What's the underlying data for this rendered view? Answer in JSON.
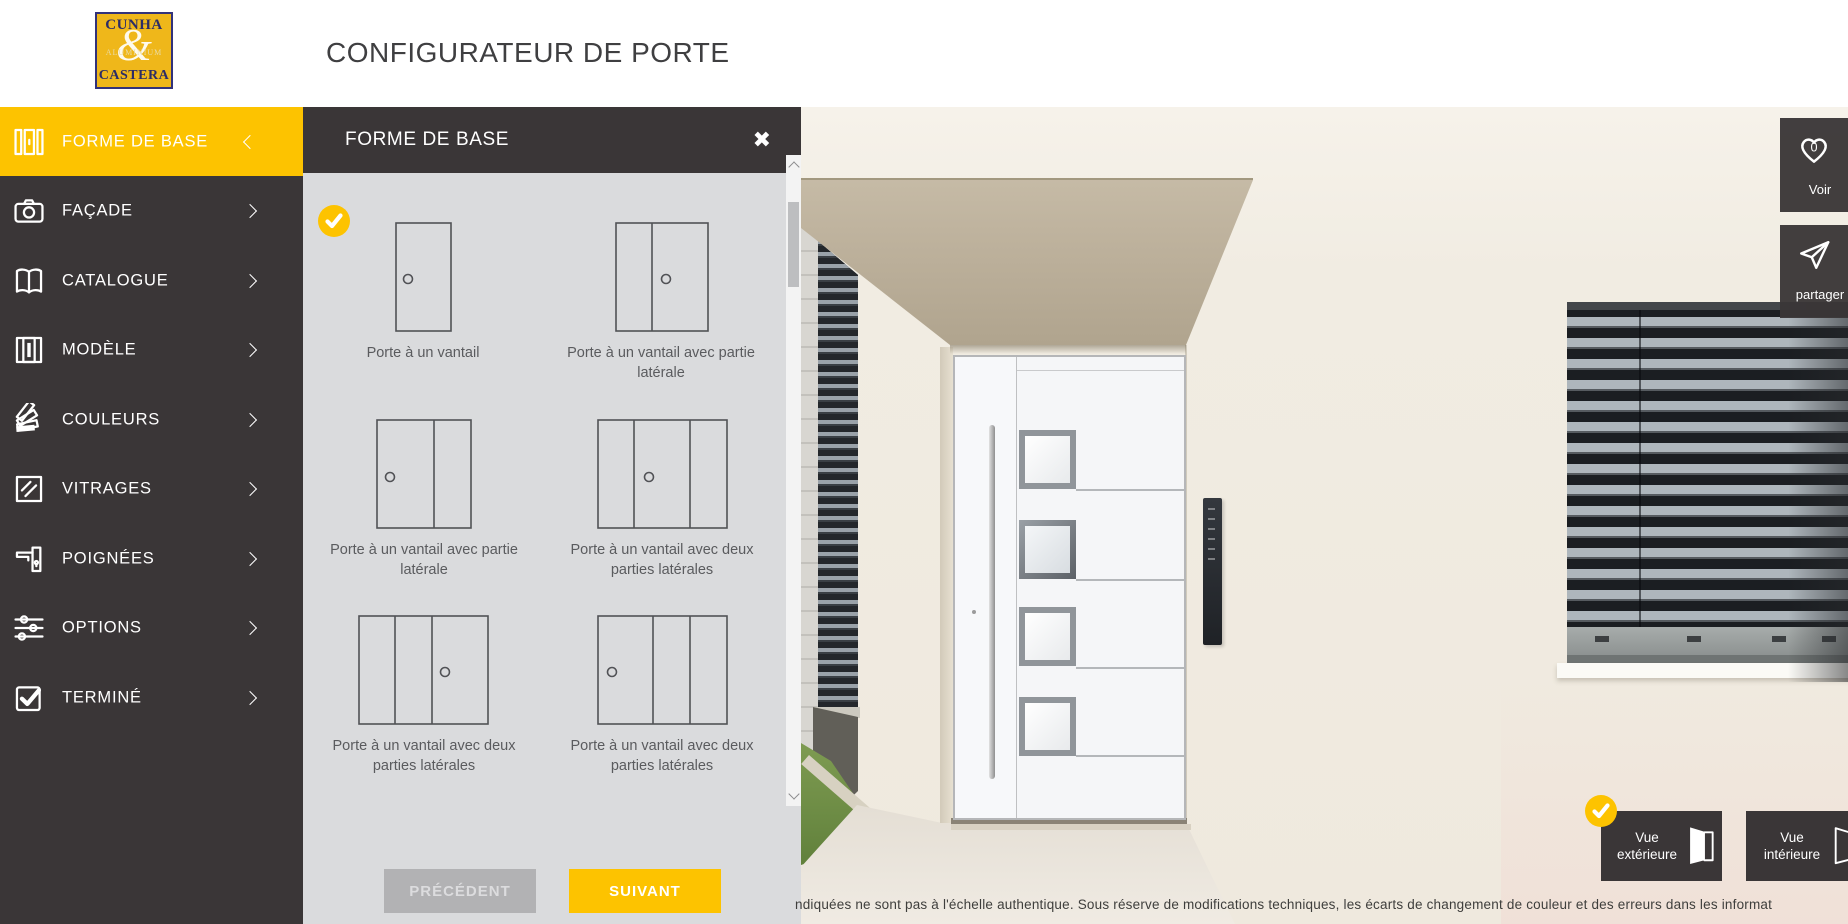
{
  "colors": {
    "accent": "#fdc300",
    "sidebar": "#3a3637",
    "panel_bg": "#dadbdd",
    "logo_bg": "#efb71a"
  },
  "header": {
    "title": "CONFIGURATEUR DE PORTE",
    "logo": {
      "line1": "CUNHA",
      "amp": "&",
      "line2": "ALUMINIUM",
      "line3": "CASTERA"
    }
  },
  "sidebar": {
    "items": [
      {
        "label": "FORME DE BASE",
        "icon": "door-shape-icon",
        "active": true,
        "chevron": "left"
      },
      {
        "label": "FAÇADE",
        "icon": "camera-icon",
        "active": false,
        "chevron": "right"
      },
      {
        "label": "CATALOGUE",
        "icon": "open-book-icon",
        "active": false,
        "chevron": "right"
      },
      {
        "label": "MODÈLE",
        "icon": "door-panel-icon",
        "active": false,
        "chevron": "right"
      },
      {
        "label": "COULEURS",
        "icon": "color-fan-icon",
        "active": false,
        "chevron": "right"
      },
      {
        "label": "VITRAGES",
        "icon": "glass-pane-icon",
        "active": false,
        "chevron": "right"
      },
      {
        "label": "POIGNÉES",
        "icon": "door-handle-icon",
        "active": false,
        "chevron": "right"
      },
      {
        "label": "OPTIONS",
        "icon": "sliders-icon",
        "active": false,
        "chevron": "right"
      },
      {
        "label": "TERMINÉ",
        "icon": "checkbox-icon",
        "active": false,
        "chevron": "right"
      }
    ]
  },
  "panel": {
    "title": "FORME DE BASE",
    "close_icon": "✖",
    "selected_option": 0,
    "options": [
      {
        "label": "Porte à un vantail",
        "selected": true
      },
      {
        "label": "Porte à un vantail avec partie latérale",
        "selected": false
      },
      {
        "label": "Porte à un vantail avec partie latérale",
        "selected": false
      },
      {
        "label": "Porte à un vantail avec deux parties latérales",
        "selected": false
      },
      {
        "label": "Porte à un vantail avec deux parties latérales",
        "selected": false
      },
      {
        "label": "Porte à un vantail avec deux parties latérales",
        "selected": false
      }
    ],
    "buttons": {
      "prev": "PRÉCÉDENT",
      "next": "SUIVANT"
    }
  },
  "viewer": {
    "favorites": {
      "label": "Voir",
      "count": "0"
    },
    "share": {
      "label": "partager"
    },
    "views": [
      {
        "label": "Vue extérieure",
        "selected": true
      },
      {
        "label": "Vue intérieure",
        "selected": false
      }
    ],
    "disclaimer": "ndiquées ne sont pas à l'échelle authentique. Sous réserve de modifications techniques, les écarts de changement de couleur et des erreurs dans les informat"
  }
}
